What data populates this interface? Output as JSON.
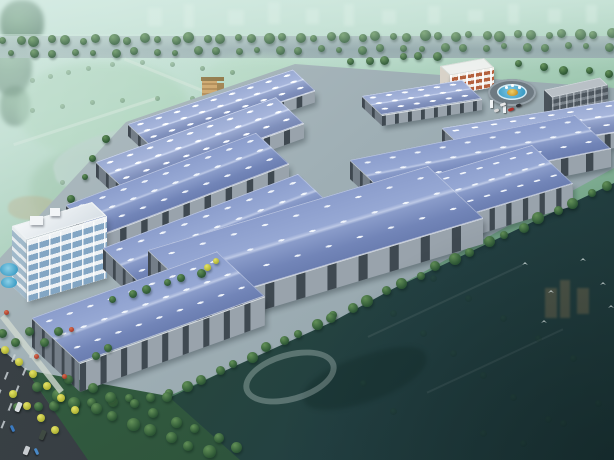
{
  "meta": {
    "type": "architectural-aerial-rendering",
    "subject": "Bird's-eye 3D rendering of an industrial logistics park with blue-roofed warehouse rows, office building, entrance roundabout and surrounding green landscape",
    "canvas_width": 614,
    "canvas_height": 460
  },
  "palette": {
    "roof_blue": "#7f92c4",
    "roof_ridge_highlight": "#bdc9e6",
    "skylight_white": "#f2f7fc",
    "wall_gray": "#99a3ac",
    "wall_bay_dark": "#3f4951",
    "ground_concrete": "#a3b2b8",
    "haze_mint": "#cfe8e0",
    "park_green": "#8cc09a",
    "field_dark_teal": "#223f3c",
    "tree_green": "#2c5634",
    "tree_yellow": "#c6cc3e",
    "office_glass": "#83a6c4",
    "admin_red": "#b4603c",
    "pool_blue": "#3e9ec6",
    "road_dark": "#363d42",
    "gold_sculpture": "#d8ac48"
  },
  "buildings": [
    {
      "id": "admin-building",
      "type": "admin",
      "x": 440,
      "y": 66,
      "w": 44,
      "d": 15,
      "h": 20,
      "s": -0.18
    },
    {
      "id": "warehouse-ne-row1",
      "type": "warehouse",
      "x": 362,
      "y": 96,
      "w": 100,
      "d": 30,
      "h": 10,
      "s": -0.16,
      "far": true
    },
    {
      "id": "dormitory-building",
      "type": "dorm",
      "x": 544,
      "y": 90,
      "w": 56,
      "d": 12,
      "h": 46,
      "s": -0.22
    },
    {
      "id": "warehouse-nw-row1",
      "type": "warehouse",
      "x": 128,
      "y": 124,
      "w": 165,
      "d": 34,
      "h": 11,
      "s": -0.33,
      "far": true
    },
    {
      "id": "warehouse-ne-row2",
      "type": "warehouse",
      "x": 442,
      "y": 128,
      "w": 172,
      "d": 44,
      "h": 15,
      "s": -0.16,
      "far": true
    },
    {
      "id": "warehouse-nw-row2",
      "type": "warehouse",
      "x": 96,
      "y": 162,
      "w": 180,
      "d": 42,
      "h": 14,
      "s": -0.36,
      "far": true
    },
    {
      "id": "warehouse-ne-row3",
      "type": "warehouse",
      "x": 350,
      "y": 160,
      "w": 225,
      "d": 54,
      "h": 18,
      "s": -0.2
    },
    {
      "id": "warehouse-east-front",
      "type": "warehouse",
      "x": 382,
      "y": 190,
      "w": 150,
      "d": 62,
      "h": 22,
      "s": -0.3
    },
    {
      "id": "warehouse-nw-row3",
      "type": "warehouse",
      "x": 66,
      "y": 205,
      "w": 190,
      "d": 50,
      "h": 17,
      "s": -0.38
    },
    {
      "id": "office-building",
      "type": "office",
      "x": 12,
      "y": 226,
      "w": 80,
      "d": 22,
      "h": 60,
      "s": -0.3
    },
    {
      "id": "warehouse-west-row2",
      "type": "warehouse",
      "x": 103,
      "y": 248,
      "w": 195,
      "d": 58,
      "h": 20,
      "s": -0.38
    },
    {
      "id": "warehouse-center-front",
      "type": "warehouse",
      "x": 148,
      "y": 250,
      "w": 280,
      "d": 84,
      "h": 25,
      "s": -0.3
    },
    {
      "id": "warehouse-west-front",
      "type": "warehouse",
      "x": 32,
      "y": 318,
      "w": 185,
      "d": 72,
      "h": 28,
      "s": -0.36
    }
  ],
  "roundabout": {
    "cx": 512,
    "cy": 92,
    "outer_w": 48,
    "outer_h": 27,
    "pool_w": 30,
    "pool_h": 16,
    "island_w": 11,
    "island_h": 7,
    "jets": [
      [
        505,
        86
      ],
      [
        511,
        84
      ],
      [
        518,
        86
      ]
    ]
  },
  "gate_posts": [
    [
      490,
      100,
      3,
      8
    ],
    [
      503,
      106,
      3,
      7
    ]
  ],
  "tree_lines": [
    {
      "name": "boulevard-trees-back-row",
      "layer": "behind",
      "from": [
        4,
        41
      ],
      "to": [
        610,
        34
      ],
      "n": 40,
      "size": [
        7,
        11
      ]
    },
    {
      "name": "boulevard-trees-front-row",
      "layer": "behind",
      "from": [
        12,
        54
      ],
      "to": [
        608,
        46
      ],
      "n": 30,
      "size": [
        6,
        9
      ],
      "opacity": 0.9
    },
    {
      "name": "north-boundary-trees",
      "layer": "behind",
      "from": [
        352,
        62
      ],
      "to": [
        436,
        55
      ],
      "n": 6,
      "size": [
        7,
        9
      ]
    },
    {
      "name": "dorm-side-trees",
      "layer": "behind",
      "from": [
        520,
        64
      ],
      "to": [
        610,
        74
      ],
      "n": 5,
      "size": [
        7,
        9
      ]
    },
    {
      "name": "west-boundary-trees",
      "layer": "behind",
      "from": [
        52,
        238
      ],
      "to": [
        104,
        138
      ],
      "n": 6,
      "size": [
        6,
        8
      ]
    },
    {
      "name": "central-road-trees",
      "layer": "behind",
      "from": [
        300,
        180
      ],
      "to": [
        262,
        222
      ],
      "n": 3,
      "size": [
        7,
        8
      ]
    },
    {
      "name": "southeast-road-trees",
      "layer": "front",
      "from": [
        334,
        316
      ],
      "to": [
        608,
        186
      ],
      "n": 17,
      "size": [
        8,
        12
      ]
    },
    {
      "name": "south-road-trees",
      "layer": "front",
      "from": [
        170,
        394
      ],
      "to": [
        332,
        318
      ],
      "n": 11,
      "size": [
        8,
        11
      ]
    },
    {
      "name": "southwest-road-trees",
      "layer": "front",
      "from": [
        18,
        408
      ],
      "to": [
        168,
        396
      ],
      "n": 9,
      "size": [
        8,
        10
      ]
    },
    {
      "name": "greenbelt-trees-1",
      "layer": "front",
      "from": [
        38,
        388
      ],
      "to": [
        208,
        452
      ],
      "n": 10,
      "size": [
        10,
        13
      ]
    },
    {
      "name": "greenbelt-trees-2",
      "layer": "front",
      "from": [
        70,
        380
      ],
      "to": [
        238,
        446
      ],
      "n": 9,
      "size": [
        9,
        11
      ]
    },
    {
      "name": "junction-trees",
      "layer": "front",
      "from": [
        114,
        300
      ],
      "to": [
        200,
        272
      ],
      "n": 6,
      "size": [
        7,
        9
      ]
    }
  ],
  "trees_front_extra": [
    {
      "x": 207,
      "y": 267,
      "size": 7,
      "type": "yellow"
    },
    {
      "x": 216,
      "y": 261,
      "size": 6,
      "type": "yellow"
    },
    {
      "x": 96,
      "y": 356,
      "size": 8,
      "type": "green"
    },
    {
      "x": 108,
      "y": 348,
      "size": 8,
      "type": "green"
    }
  ],
  "plaza": {
    "pools": [
      [
        0,
        263,
        18,
        13
      ],
      [
        1,
        277,
        16,
        11
      ]
    ],
    "yellow_trees": [
      [
        5,
        350
      ],
      [
        19,
        362
      ],
      [
        33,
        374
      ],
      [
        47,
        386
      ],
      [
        61,
        398
      ],
      [
        75,
        410
      ],
      [
        13,
        394
      ],
      [
        27,
        406
      ],
      [
        41,
        418
      ],
      [
        55,
        430
      ]
    ],
    "green_trees": [
      [
        2,
        333
      ],
      [
        15,
        342
      ],
      [
        29,
        331
      ],
      [
        44,
        342
      ],
      [
        58,
        331
      ]
    ],
    "red_shrubs": [
      [
        64,
        376
      ],
      [
        71,
        329
      ],
      [
        36,
        356
      ],
      [
        6,
        312
      ]
    ],
    "path": {
      "x": 0,
      "y": 318,
      "w": 6,
      "h": 96,
      "rot": -38
    }
  },
  "vehicles": {
    "road_cars": [
      {
        "x": 16,
        "y": 402,
        "rot": 22,
        "w": 5,
        "h": 10,
        "c": "#d8dde0"
      },
      {
        "x": 40,
        "y": 430,
        "rot": 22,
        "w": 5,
        "h": 10,
        "c": "#3f4a42"
      },
      {
        "x": 24,
        "y": 446,
        "rot": 22,
        "w": 5,
        "h": 9,
        "c": "#c8ccd0"
      }
    ],
    "plaza_cars": [
      {
        "x": 9,
        "y": 427,
        "rot": 65,
        "w": 7,
        "h": 3,
        "c": "#3a7ac0"
      },
      {
        "x": 33,
        "y": 450,
        "rot": 65,
        "w": 7,
        "h": 3,
        "c": "#4a8ac8"
      }
    ],
    "roundabout_cars": [
      {
        "x": 500,
        "y": 103,
        "rot": -20,
        "w": 6,
        "h": 3,
        "c": "#e8e8e8"
      },
      {
        "x": 508,
        "y": 108,
        "rot": -20,
        "w": 6,
        "h": 3,
        "c": "#b03028"
      },
      {
        "x": 516,
        "y": 104,
        "rot": -20,
        "w": 5,
        "h": 3,
        "c": "#30343a"
      },
      {
        "x": 494,
        "y": 109,
        "rot": -20,
        "w": 5,
        "h": 3,
        "c": "#d8d8d8"
      }
    ]
  },
  "birds": [
    [
      522,
      262
    ],
    [
      548,
      290
    ],
    [
      580,
      258
    ],
    [
      600,
      282
    ],
    [
      541,
      320
    ],
    [
      608,
      305
    ]
  ],
  "city_blocks": [
    [
      148,
      8,
      14,
      18
    ],
    [
      184,
      4,
      10,
      24
    ],
    [
      228,
      10,
      16,
      15
    ],
    [
      268,
      2,
      12,
      22
    ],
    [
      306,
      9,
      13,
      15
    ],
    [
      344,
      4,
      10,
      22
    ],
    [
      382,
      10,
      14,
      14
    ],
    [
      428,
      6,
      12,
      18
    ],
    [
      468,
      10,
      15,
      12
    ],
    [
      508,
      4,
      11,
      20
    ],
    [
      548,
      9,
      13,
      14
    ],
    [
      586,
      5,
      11,
      18
    ]
  ],
  "corner_foliage": [
    [
      0,
      0,
      44,
      46
    ],
    [
      -8,
      38,
      40,
      58
    ],
    [
      0,
      86,
      30,
      40
    ]
  ],
  "park": {
    "patches": [
      {
        "x": 18,
        "y": 62,
        "w": 170,
        "h": 95,
        "c": "#a6d0b2",
        "o": 0.55
      },
      {
        "x": 150,
        "y": 110,
        "w": 150,
        "h": 85,
        "c": "#8cc09a",
        "o": 0.5
      },
      {
        "x": 30,
        "y": 150,
        "w": 130,
        "h": 80,
        "c": "#84b28e",
        "o": 0.45
      },
      {
        "x": 200,
        "y": 55,
        "w": 120,
        "h": 70,
        "c": "#b4d8c0",
        "o": 0.5
      }
    ],
    "lakes": [
      {
        "x": 52,
        "y": 128,
        "w": 155,
        "h": 52,
        "rot": -14,
        "c": "#b6cdc6",
        "o": 0.85
      },
      {
        "x": 150,
        "y": 166,
        "w": 56,
        "h": 20,
        "rot": -14,
        "c": "#aac4bc",
        "o": 0.7
      }
    ],
    "roads": [
      {
        "x": 10,
        "y": 120,
        "w": 150,
        "h": 3,
        "rot": -18
      },
      {
        "x": 120,
        "y": 80,
        "w": 120,
        "h": 3,
        "rot": 22
      }
    ],
    "quarry": {
      "x": 8,
      "y": 196,
      "w": 48,
      "h": 24,
      "c": "#b09a6e",
      "o": 0.5
    },
    "hedge_trees": [
      [
        30,
        78
      ],
      [
        48,
        74
      ],
      [
        66,
        70
      ],
      [
        86,
        66
      ],
      [
        110,
        62
      ],
      [
        140,
        60
      ],
      [
        170,
        62
      ],
      [
        200,
        66
      ],
      [
        230,
        70
      ],
      [
        30,
        108
      ],
      [
        60,
        104
      ],
      [
        90,
        100
      ],
      [
        120,
        98
      ],
      [
        155,
        96
      ],
      [
        190,
        96
      ],
      [
        225,
        98
      ],
      [
        258,
        102
      ],
      [
        60,
        180
      ],
      [
        90,
        176
      ],
      [
        120,
        172
      ]
    ],
    "tower": {
      "front": [
        202,
        80,
        15,
        42
      ],
      "side": [
        217,
        83,
        7,
        39
      ],
      "cap": [
        201,
        77,
        23,
        4
      ],
      "annex": [
        228,
        98,
        12,
        24
      ]
    },
    "ghost_blocks": [
      [
        288,
        72,
        18,
        58
      ],
      [
        309,
        82,
        15,
        50
      ],
      [
        270,
        96,
        13,
        34
      ]
    ]
  },
  "field": {
    "ghost_arc": {
      "x": 242,
      "y": 352,
      "w": 84,
      "h": 38,
      "rot": -16
    },
    "ghost_lake": {
      "x": 300,
      "y": 356,
      "w": 130,
      "h": 46,
      "rot": -18,
      "c": "#16302e",
      "o": 0.5
    },
    "paths": [
      {
        "x": 360,
        "y": 300,
        "w": 170,
        "h": 2,
        "rot": -25
      },
      {
        "x": 420,
        "y": 360,
        "w": 150,
        "h": 2,
        "rot": -25
      }
    ],
    "faint_trees": [
      [
        350,
        270
      ],
      [
        370,
        290
      ],
      [
        390,
        310
      ],
      [
        420,
        330
      ],
      [
        450,
        350
      ],
      [
        480,
        372
      ],
      [
        510,
        394
      ],
      [
        545,
        416
      ],
      [
        395,
        255
      ],
      [
        430,
        275
      ],
      [
        465,
        295
      ],
      [
        500,
        315
      ],
      [
        535,
        335
      ],
      [
        570,
        355
      ],
      [
        480,
        430
      ],
      [
        520,
        440
      ],
      [
        560,
        420
      ],
      [
        595,
        400
      ],
      [
        360,
        380
      ],
      [
        390,
        408
      ]
    ],
    "tan_towers": [
      [
        545,
        288,
        12,
        30
      ],
      [
        560,
        280,
        10,
        38
      ],
      [
        577,
        288,
        12,
        26
      ]
    ]
  }
}
